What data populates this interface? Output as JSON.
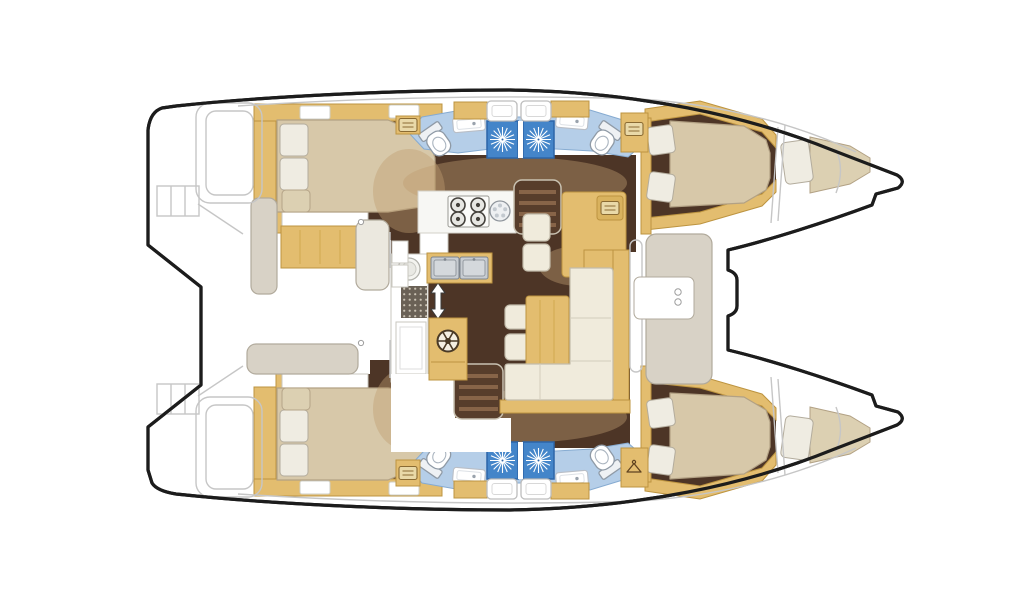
{
  "meta": {
    "title": "Catamaran interior layout floor plan (top view, bows to the right)",
    "type": "boat-floor-plan",
    "canvas": {
      "width": 1024,
      "height": 600
    },
    "orientation": {
      "bow": "right",
      "stern": "left"
    }
  },
  "palette": {
    "outline": "#1c1c1c",
    "line-light": "#c6c6c6",
    "line-mid": "#9e9e9e",
    "floor-dark": "#4d3526",
    "glow": "#bf9e6f",
    "wood": "#e3bd6f",
    "wood-edge": "#bd9440",
    "wood-deep": "#d9b25e",
    "bed": "#d7c8a9",
    "bed-edge": "#b2a184",
    "pillow": "#efece2",
    "pillow-cream": "#dcd0b2",
    "sofa": "#f0ebdc",
    "sofa-edge": "#c3bcab",
    "bath-floor": "#b5cee8",
    "bath-edge": "#86abd1",
    "shower-blue": "#4485c9",
    "shower-deep": "#2d65a8",
    "counter": "#f7f7f4",
    "steel": "#c7ccd1",
    "seat-gray": "#d8d2c6",
    "seat-edge": "#b1aa9c"
  },
  "legend": {
    "bridgedeck": {
      "aft_cockpit": [
        "cockpit-table",
        "side-bench",
        "aft-bench",
        "corner-seat"
      ],
      "saloon": [
        "galley-counter",
        "stove-4-burners",
        "round-sink",
        "double-steel-sink",
        "front-loader-appliance",
        "floor-grate",
        "chart-table",
        "coffee-table",
        "l-shaped-sofa",
        "seat-cushions",
        "companionway-stairs-port",
        "companionway-stairs-starboard",
        "helm-wheel-emblem",
        "up-down-arrow"
      ],
      "foredeck": [
        "forward-seat",
        "open-bow-deck"
      ]
    },
    "upper_hull": [
      "transom-steps",
      "aft-double-cabin",
      "aft-head-toilet-sink",
      "shower-cubicle",
      "shower-cubicle",
      "forward-head-toilet-sink",
      "wardrobe",
      "forward-double-cabin",
      "forepeak-berth"
    ],
    "lower_hull": [
      "transom-steps",
      "aft-double-cabin",
      "aft-head-toilet-sink",
      "shower-cubicle",
      "shower-cubicle",
      "forward-head-toilet-sink",
      "wardrobe",
      "forward-double-cabin",
      "forepeak-berth"
    ],
    "fixture_counts": {
      "toilets": 4,
      "showers": 4,
      "double_beds": 4,
      "bow_single_berths": 2,
      "stove_burners": 4,
      "deck_hatches": 8,
      "cockpit_tables": 1,
      "coffee_tables": 1
    },
    "icons": [
      "shower-sunburst-icon",
      "toilet-icon",
      "sink-icon",
      "stove-burner-icon",
      "hanger-icon",
      "vent-icon",
      "wheel-icon",
      "up-down-arrow-icon",
      "deck-hatch-icon",
      "stairs-icon"
    ]
  }
}
